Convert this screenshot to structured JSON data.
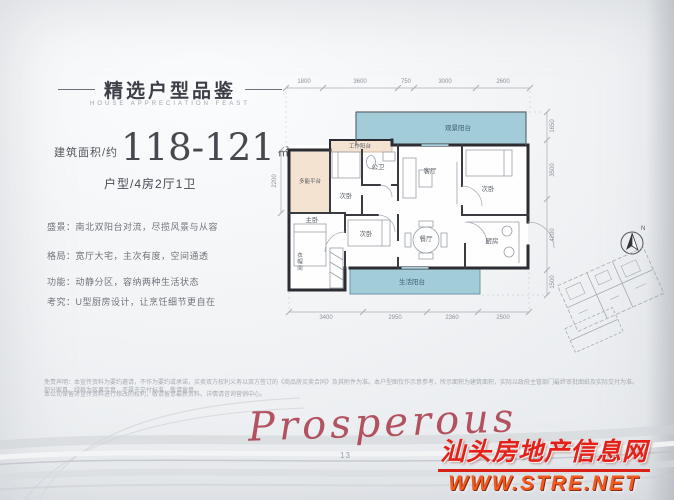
{
  "header": {
    "title": "精选户型品鉴",
    "subtitle": "HOUSE APPRECIATION FEAST",
    "area_label": "建筑面积/约",
    "area_value": "118-121",
    "area_unit": "㎡",
    "layout_label": "户型/4房2厅1卫"
  },
  "features": [
    "盛景：南北双阳台对流，尽揽风景与从容",
    "格局：宽厅大宅，主次有度，空间通透",
    "功能：动静分区，容纳两种生活状态",
    "考究：U型厨房设计，让烹饪细节更自在"
  ],
  "floorplan": {
    "dims_top": [
      "1800",
      "3600",
      "750",
      "3000",
      "2600"
    ],
    "dims_bottom": [
      "3400",
      "2950",
      "2360",
      "2500"
    ],
    "dims_right": [
      "1650",
      "3500",
      "4200",
      "1500"
    ],
    "dims_left": [
      "2200"
    ],
    "rooms": {
      "view_balcony": "观景阳台",
      "living": "客厅",
      "dining": "餐厅",
      "kitchen": "厨房",
      "master": "主卧",
      "bedroom2": "次卧",
      "bedroom3": "次卧",
      "bedroom4": "次卧",
      "bath": "公卫",
      "life_balcony": "生活阳台",
      "platform": "多能平台",
      "work_balcony": "工作阳台",
      "cloak": "衣帽间"
    },
    "compass_label": "N",
    "colors": {
      "balcony_fill": "#a3ccd9",
      "platform_fill": "#f4e3d1",
      "wall": "#2c2c33"
    }
  },
  "footer": {
    "disclaimer_line1": "免责声明：本宣传资料为要约邀请，不作为要约或承诺，买卖双方权利义务以双方签订的《商品房买卖合同》及其附件为准。本户型图仅作示意参考，所示面积为建筑面积，实际以政府主管部门最终审批图纸及实际交付为准。部分家具、绿植为效果示意，不属于交付标准，敬请留意。",
    "disclaimer_line2": "本公司保留对宣传资料进行修改的权利，敬请留意最新资料。详情请咨询营销中心。",
    "page_number": "13",
    "script_text": "Prosperous",
    "watermark_line1": "汕头房地产信息网",
    "watermark_line2": "WWW.STRE.NET",
    "watermark_color": "#e32119"
  }
}
